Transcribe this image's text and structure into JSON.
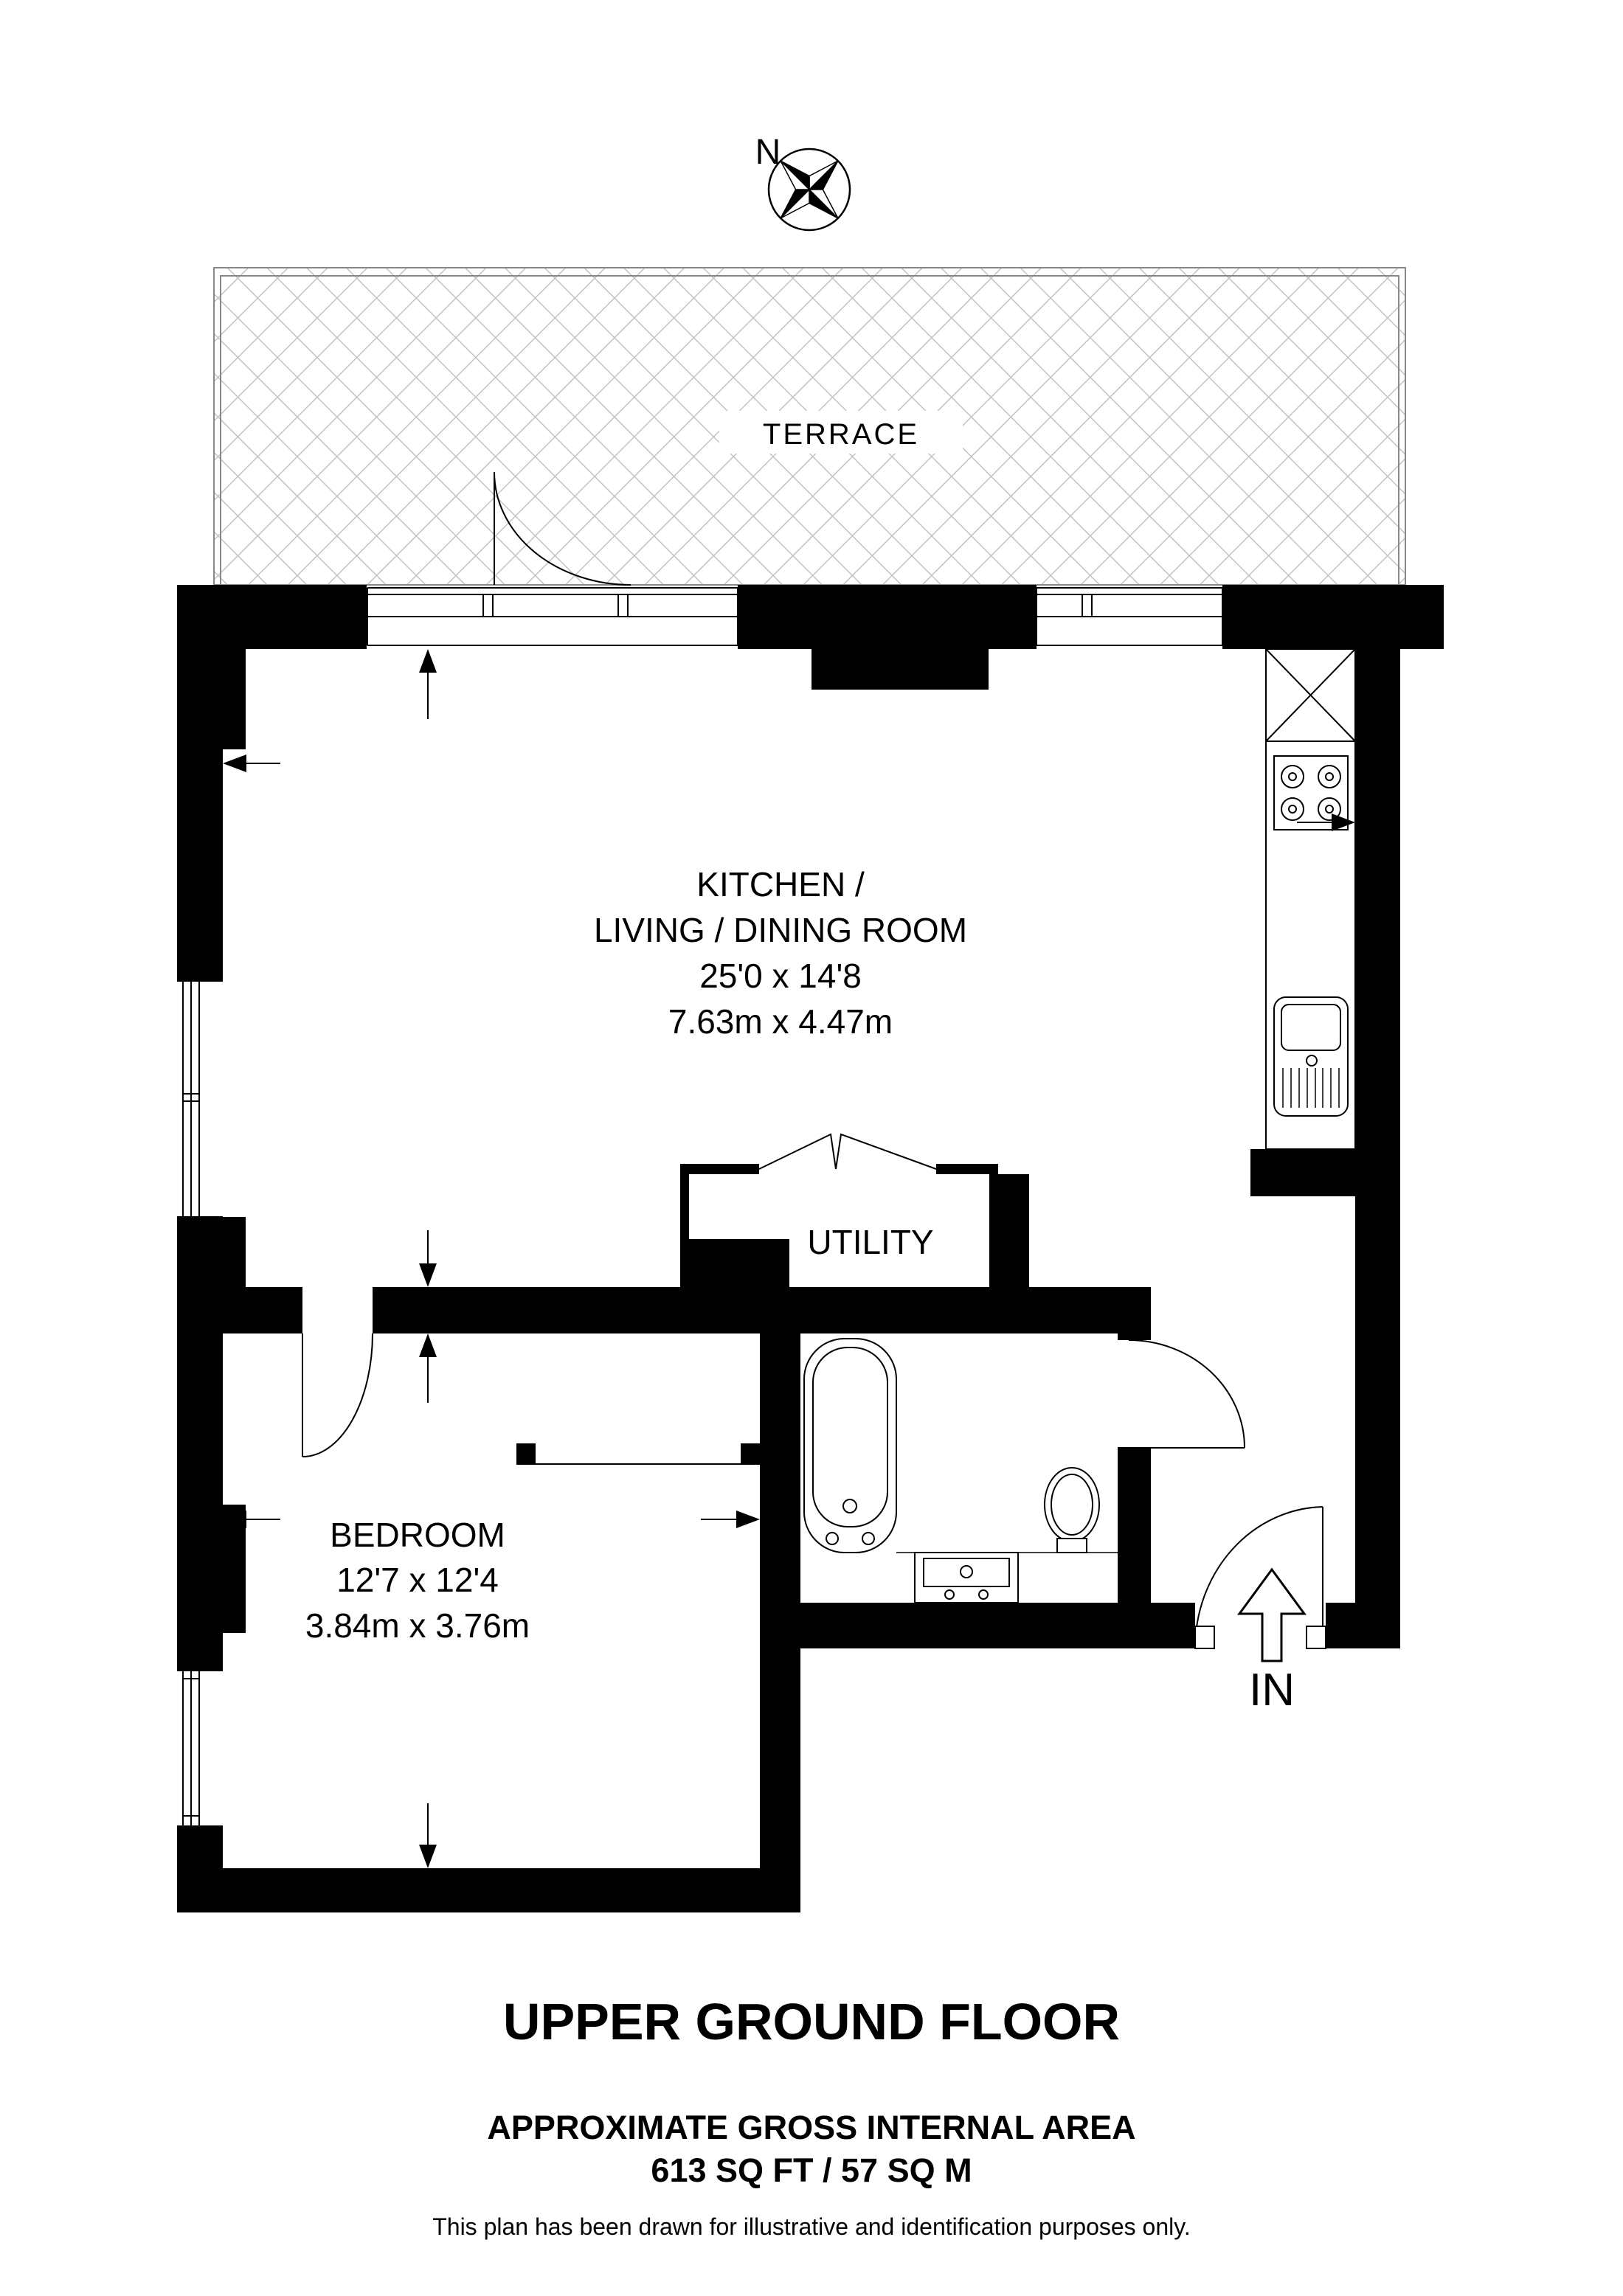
{
  "compass": {
    "north_label": "N"
  },
  "terrace": {
    "label": "TERRACE"
  },
  "rooms": {
    "kitchen_living_dining": {
      "name_line1": "KITCHEN /",
      "name_line2": "LIVING / DINING  ROOM",
      "dimensions_imperial": "25'0 x 14'8",
      "dimensions_metric": "7.63m x 4.47m"
    },
    "utility": {
      "name": "UTILITY"
    },
    "bedroom": {
      "name": "BEDROOM",
      "dimensions_imperial": "12'7 x 12'4",
      "dimensions_metric": "3.84m x 3.76m"
    }
  },
  "entrance": {
    "label": "IN"
  },
  "footer": {
    "floor_title": "UPPER GROUND FLOOR",
    "area_heading": "APPROXIMATE GROSS INTERNAL AREA",
    "area_value": "613 SQ FT / 57 SQ M",
    "disclaimer": "This plan has been drawn for illustrative and identification purposes only."
  },
  "colors": {
    "wall": "#000000",
    "hatch_line": "#c3c3c3",
    "terrace_border": "#888888",
    "background": "#ffffff"
  }
}
